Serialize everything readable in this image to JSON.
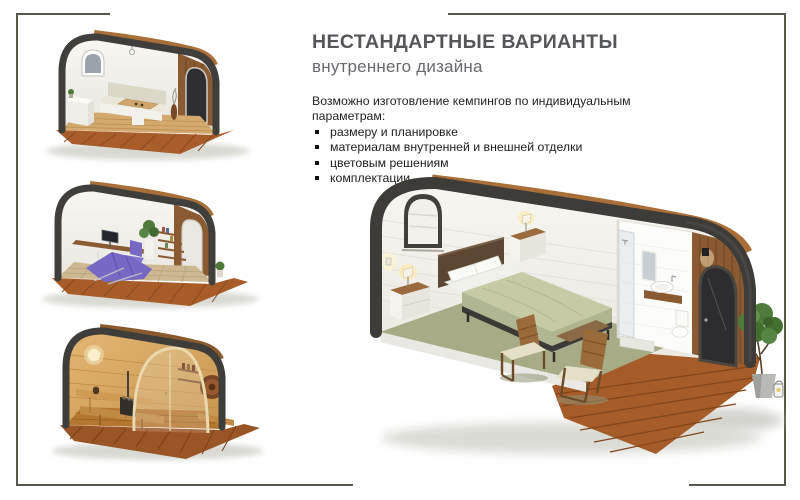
{
  "header": {
    "title": "НЕСТАНДАРТНЫЕ ВАРИАНТЫ",
    "subtitle": "внутреннего дизайна"
  },
  "body": {
    "intro": "Возможно изготовление кемпингов по индивидуальным параметрам:",
    "bullets": [
      "размеру и планировке",
      "материалам внутренней и внешней отделки",
      "цветовым решениям",
      "комплектации"
    ]
  },
  "images": {
    "pod1": "dining-interior-pod-render",
    "pod2": "office-interior-pod-render",
    "pod3": "sauna-interior-pod-render",
    "pod4": "bedroom-interior-pod-render"
  },
  "colors": {
    "frame_border": "#57564c",
    "title_gray": "#55565a",
    "body_text": "#1d1d1d",
    "pod_rim": "#3e3c39",
    "deck_wood": "#a55c28",
    "sage_floor": "#a7ab86",
    "purple_lounger": "#7668c4",
    "sauna_wood": "#d9a965"
  }
}
